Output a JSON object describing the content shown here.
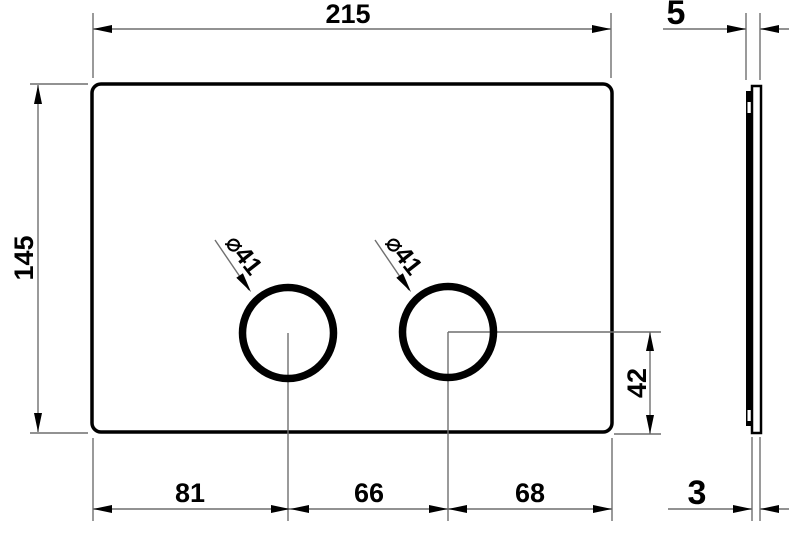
{
  "drawing": {
    "front": {
      "width_label": "215",
      "height_label": "145",
      "dia_left_label": "⌀41",
      "dia_right_label": "⌀41",
      "hole_offset_label": "42",
      "bottom_segments": [
        "81",
        "66",
        "68"
      ]
    },
    "side": {
      "total_thickness_label": "5",
      "plate_thickness_label": "3"
    },
    "colors": {
      "outline": "#000000",
      "dimension_lines": "#6f6f6f",
      "text": "#000000",
      "background": "#ffffff"
    }
  }
}
